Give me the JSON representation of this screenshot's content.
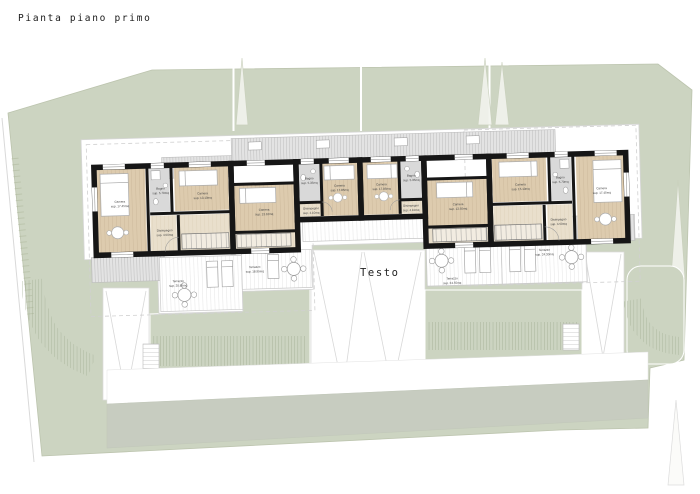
{
  "title": "Pianta piano primo",
  "center_label": "Testo",
  "colors": {
    "lot_green": "#ccd4c1",
    "road_band": "#c7ccc0",
    "floor_wood": "#ddcbae",
    "floor_hall": "#e9dfcc",
    "bath_gray": "#d9d9d9",
    "roof_gray": "#e3e3e3",
    "wall_black": "#161616"
  },
  "rooms": {
    "a_cam1": {
      "name": "Camera",
      "area": "sup. 17.45mq"
    },
    "a_bagno": {
      "name": "Bagno",
      "area": "sup. 5.70mq"
    },
    "a_cam2": {
      "name": "Camera",
      "area": "sup. 13.10mq"
    },
    "a_dis": {
      "name": "Disimpegno",
      "area": "sup. 4.50mq"
    },
    "b_cam": {
      "name": "Camera",
      "area": "sup. 13.10mq"
    },
    "c_cam": {
      "name": "Camera",
      "area": "sup. 17.85mq"
    },
    "c_bagno": {
      "name": "Bagno",
      "area": "sup. 5.35mq"
    },
    "c_dis": {
      "name": "Disimpegno",
      "area": "sup. 4.10mq"
    },
    "d_cam": {
      "name": "Camera",
      "area": "sup. 17.85mq"
    },
    "d_bagno": {
      "name": "Bagno",
      "area": "sup. 5.35mq"
    },
    "d_dis": {
      "name": "Disimpegno",
      "area": "sup. 4.10mq"
    },
    "e_cam": {
      "name": "Camera",
      "area": "sup. 13.50mq"
    },
    "f_cam2": {
      "name": "Camera",
      "area": "sup. 15.10mq"
    },
    "f_bagno": {
      "name": "Bagno",
      "area": "sup. 5.70mq"
    },
    "f_cam1": {
      "name": "Camera",
      "area": "sup. 17.45mq"
    },
    "f_dis": {
      "name": "Disimpegno",
      "area": "sup. 4.50mq"
    },
    "t_a": {
      "name": "Terrazzo",
      "area": "sup. 20.85mq"
    },
    "t_b": {
      "name": "Terrazzo",
      "area": "sup. 18.95mq"
    },
    "t_e": {
      "name": "Terrazzo",
      "area": "sup. 24.55mq"
    },
    "t_f": {
      "name": "Terrazzo",
      "area": "sup. 24.30mq"
    }
  }
}
